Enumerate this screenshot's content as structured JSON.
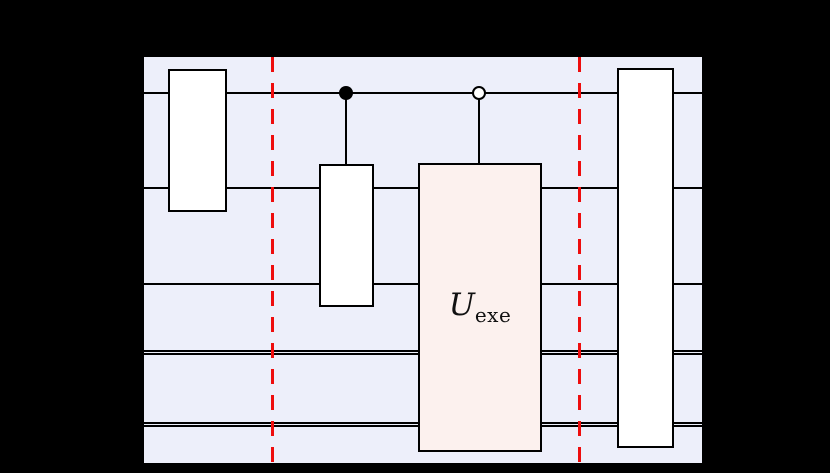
{
  "figure": {
    "kind": "quantum-circuit-diagram",
    "colors": {
      "canvas_background": "#000000",
      "panel_background": "#EDEFFA",
      "wire": "#000000",
      "gate_fill": "#FFFFFF",
      "gate_border": "#000000",
      "u_gate_fill": "#FCF1EE",
      "barrier_red": "#EE0D0D"
    },
    "u_gate_label": {
      "base": "U",
      "subscript": "exe"
    },
    "circuit": {
      "wires": [
        {
          "index": 1,
          "type": "quantum"
        },
        {
          "index": 2,
          "type": "quantum"
        },
        {
          "index": 3,
          "type": "quantum"
        },
        {
          "index": 4,
          "type": "classical-double"
        },
        {
          "index": 5,
          "type": "classical-double"
        }
      ],
      "gates": [
        {
          "id": "box-1",
          "label": "",
          "spans_wires": [
            1,
            2
          ]
        },
        {
          "id": "box-2",
          "label": "",
          "spans_wires": [
            2,
            3
          ],
          "control": {
            "wire": 1,
            "style": "filled-dot"
          }
        },
        {
          "id": "u-exe",
          "label": "U_exe",
          "spans_wires": [
            2,
            3,
            4,
            5
          ],
          "control": {
            "wire": 1,
            "style": "open-dot"
          }
        },
        {
          "id": "box-3",
          "label": "",
          "spans_wires": [
            1,
            2,
            3,
            4,
            5
          ]
        }
      ],
      "barriers": [
        {
          "id": "barrier-1",
          "style": "red-dashed"
        },
        {
          "id": "barrier-2",
          "style": "red-dashed"
        }
      ]
    }
  }
}
